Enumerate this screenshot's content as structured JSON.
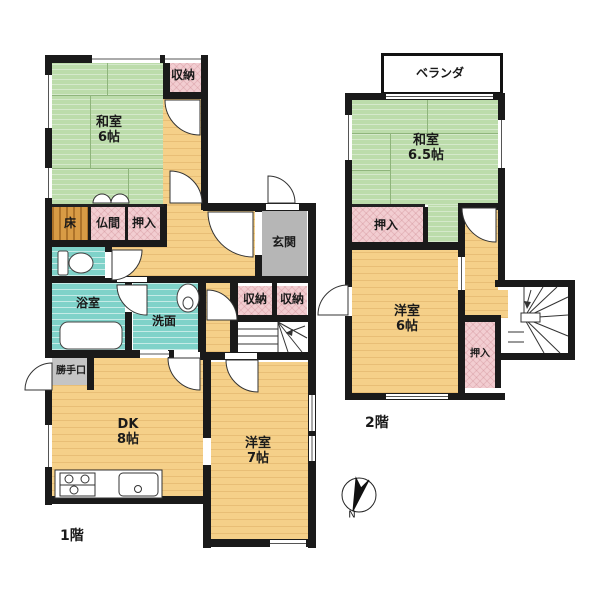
{
  "floor1": {
    "label": "1階",
    "rooms": {
      "washitsu": {
        "name": "和室",
        "size": "6帖"
      },
      "storage_top": {
        "name": "収納"
      },
      "toko": {
        "name": "床"
      },
      "butsuma": {
        "name": "仏間"
      },
      "oshiire": {
        "name": "押入"
      },
      "genkan": {
        "name": "玄関"
      },
      "bath": {
        "name": "浴室"
      },
      "senmen": {
        "name": "洗面"
      },
      "storage_a": {
        "name": "収納"
      },
      "storage_b": {
        "name": "収納"
      },
      "katteguchi": {
        "name": "勝手口"
      },
      "dk": {
        "name": "DK",
        "size": "8帖"
      },
      "yoshitsu": {
        "name": "洋室",
        "size": "7帖"
      }
    }
  },
  "floor2": {
    "label": "2階",
    "rooms": {
      "veranda": {
        "name": "ベランダ"
      },
      "washitsu": {
        "name": "和室",
        "size": "6.5帖"
      },
      "oshiire_top": {
        "name": "押入"
      },
      "yoshitsu": {
        "name": "洋室",
        "size": "6帖"
      },
      "oshiire_right": {
        "name": "押入"
      }
    }
  },
  "compass": {
    "north_label": "N"
  },
  "colors": {
    "wall": "#1a1a1a",
    "tatami": "#bcdcab",
    "wood_floor": "#f5d089",
    "closet_pink": "#f2cdd1",
    "water_teal": "#7fd2c9",
    "genkan_gray": "#b6b6b6",
    "tokonoma_wood": "#d89b45"
  }
}
